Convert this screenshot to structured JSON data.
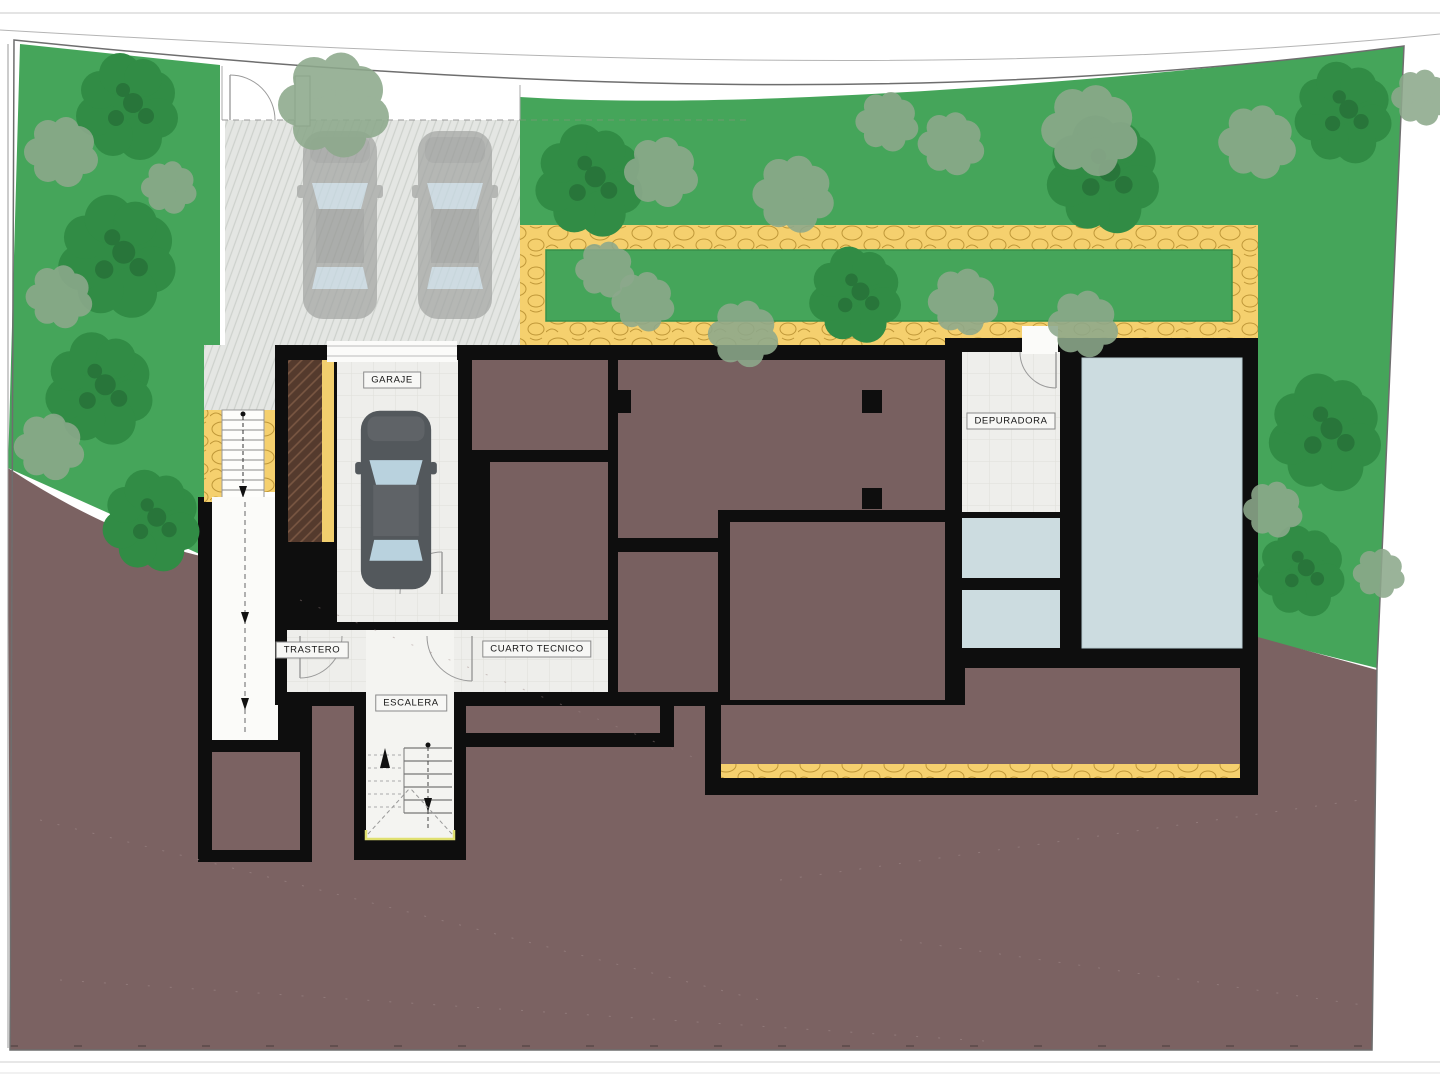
{
  "plan": {
    "title": "Basement / site plan",
    "rooms": [
      {
        "id": "garaje",
        "label": "GARAJE"
      },
      {
        "id": "depuradora",
        "label": "DEPURADORA"
      },
      {
        "id": "trastero",
        "label": "TRASTERO"
      },
      {
        "id": "cuarto-tecnico",
        "label": "CUARTO TECNICO"
      },
      {
        "id": "escalera",
        "label": "ESCALERA"
      }
    ],
    "features": {
      "driveway_cars": 2,
      "garage_cars": 1,
      "icons": [
        "tree-icon",
        "bush-icon",
        "car-icon",
        "stairs-icon",
        "door-arc-icon",
        "pool"
      ]
    },
    "palette": {
      "grass": "#45a55a",
      "tree": "#2f8b42",
      "bush": "#8da98c",
      "terrain": "#7b6262",
      "path": "#f5d06e",
      "path_stone": "#bf9738",
      "wall": "#0e0e0e",
      "floor": "#eeeeeb",
      "water": "#ccdce0",
      "driveway": "#e4e6e3",
      "wall_section": "#543a2d"
    }
  }
}
